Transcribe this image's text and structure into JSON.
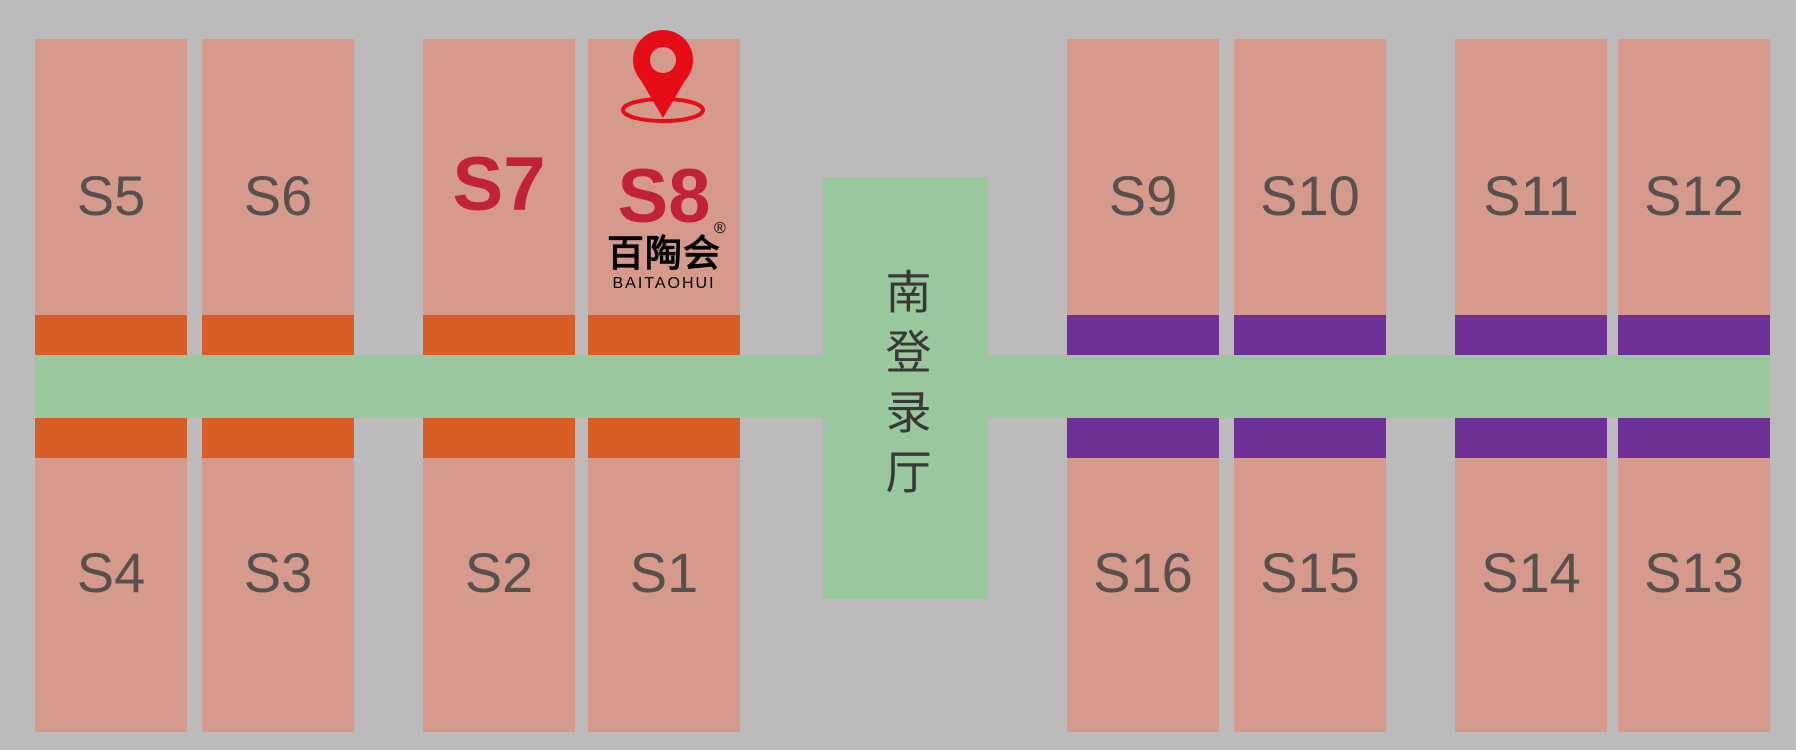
{
  "colors": {
    "background": "#bcbaba",
    "hall": "#d59a8b",
    "corridor": "#99c79e",
    "bar_left": "#d65d26",
    "bar_right": "#6f3097",
    "label": "#57504c",
    "highlight": "#c2213a",
    "pin": "#e60d17",
    "center_label": "#3a3835",
    "logo": "#000000"
  },
  "center_hall": {
    "label": "南登录厅"
  },
  "halls": {
    "top": [
      {
        "label": "S5",
        "accent": "orange",
        "highlighted": false
      },
      {
        "label": "S6",
        "accent": "orange",
        "highlighted": false
      },
      {
        "label": "S7",
        "accent": "orange",
        "highlighted": true
      },
      {
        "label": "S8",
        "accent": "orange",
        "highlighted": true
      },
      {
        "label": "S9",
        "accent": "purple",
        "highlighted": false
      },
      {
        "label": "S10",
        "accent": "purple",
        "highlighted": false
      },
      {
        "label": "S11",
        "accent": "purple",
        "highlighted": false
      },
      {
        "label": "S12",
        "accent": "purple",
        "highlighted": false
      }
    ],
    "bottom": [
      {
        "label": "S4",
        "accent": "orange",
        "highlighted": false
      },
      {
        "label": "S3",
        "accent": "orange",
        "highlighted": false
      },
      {
        "label": "S2",
        "accent": "orange",
        "highlighted": false
      },
      {
        "label": "S1",
        "accent": "orange",
        "highlighted": false
      },
      {
        "label": "S16",
        "accent": "purple",
        "highlighted": false
      },
      {
        "label": "S15",
        "accent": "purple",
        "highlighted": false
      },
      {
        "label": "S14",
        "accent": "purple",
        "highlighted": false
      },
      {
        "label": "S13",
        "accent": "purple",
        "highlighted": false
      }
    ]
  },
  "marker": {
    "icon": "location-pin",
    "hall": "S8"
  },
  "logo": {
    "zh": "百陶会",
    "registered": "®",
    "en": "BAITAOHUI"
  }
}
